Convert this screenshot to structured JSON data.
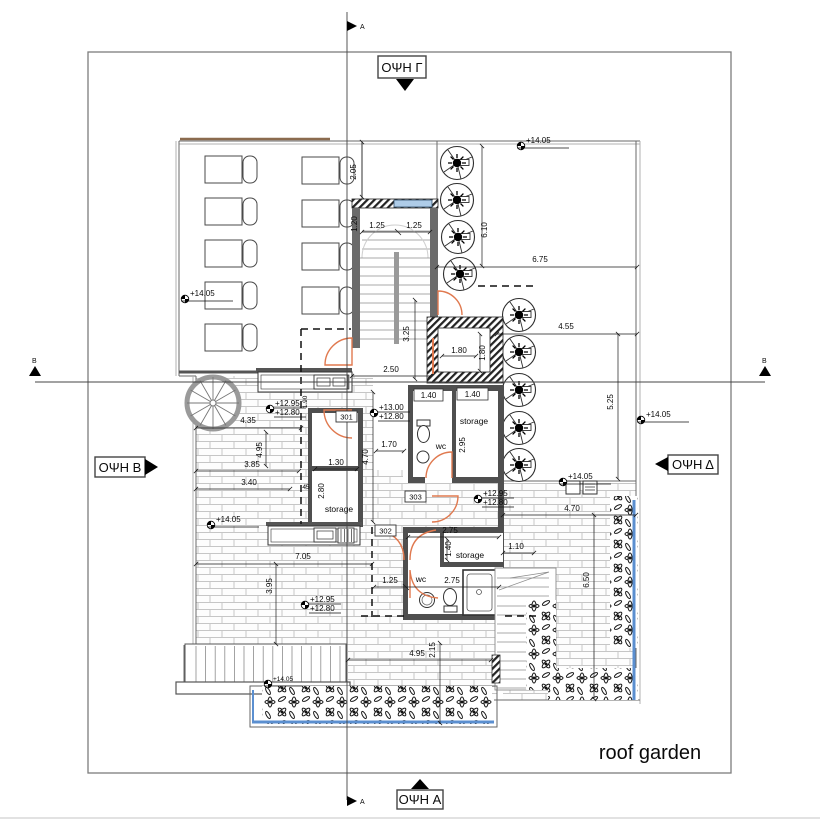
{
  "title": {
    "roof_garden": "roof garden"
  },
  "views": {
    "top": "ΟΨΗ Γ",
    "left": "ΟΨΗ B",
    "right": "ΟΨΗ Δ",
    "bottom": "ΟΨΗ A"
  },
  "sections": {
    "a": "A",
    "b": "B"
  },
  "rooms": {
    "r301": "301",
    "r302": "302",
    "r303": "303",
    "storage_mid": "storage",
    "storage_left": "storage",
    "storage_bottom": "storage",
    "wc_mid": "wc",
    "wc_bottom": "wc"
  },
  "levels": {
    "a1": "+14.05",
    "a2": "+14.05",
    "a3": "+14.05",
    "a4": "+14.05",
    "a5": "+14.05",
    "a6": "+14.05",
    "b1_top": "+12.95",
    "b1_bot": "+12.80",
    "b2_top": "+13.00",
    "b2_bot": "+12.80",
    "b3_top": "+12.95",
    "b3_bot": "+12.80",
    "b4_top": "+12.95",
    "b4_bot": "+12.80"
  },
  "dims": {
    "strip_w": "2.05",
    "stair_l": "1.25",
    "stair_r": "1.25",
    "stair_w": "1.20",
    "top_h": "6.10",
    "top_w": "6.75",
    "right_w": "4.55",
    "right_h": "5.25",
    "shaft_off": "3.25",
    "shaft_w": "1.80",
    "shaft_h": "1.80",
    "stair_total": "2.50",
    "wc_w": "1.40",
    "store_w": "1.40",
    "store_h": "2.95",
    "hall_h": "4.70",
    "hall_w": "1.70",
    "r301_w": "1.30",
    "r301_h": "2.80",
    "r301_o": "45",
    "counter_o": "1.90",
    "spiral_w": "4.35",
    "spiral_h": "4.95",
    "left_a": "3.85",
    "left_b": "3.40",
    "terr_w": "7.05",
    "terr_h": "3.95",
    "sb_w": "2.75",
    "sb_h": "1.40",
    "gap_w": "1.10",
    "wcb_a": "1.25",
    "wcb_b": "2.75",
    "bed_h": "2.15",
    "bed_w": "4.95",
    "rlow_w": "4.70",
    "rlow_h": "6.50"
  }
}
